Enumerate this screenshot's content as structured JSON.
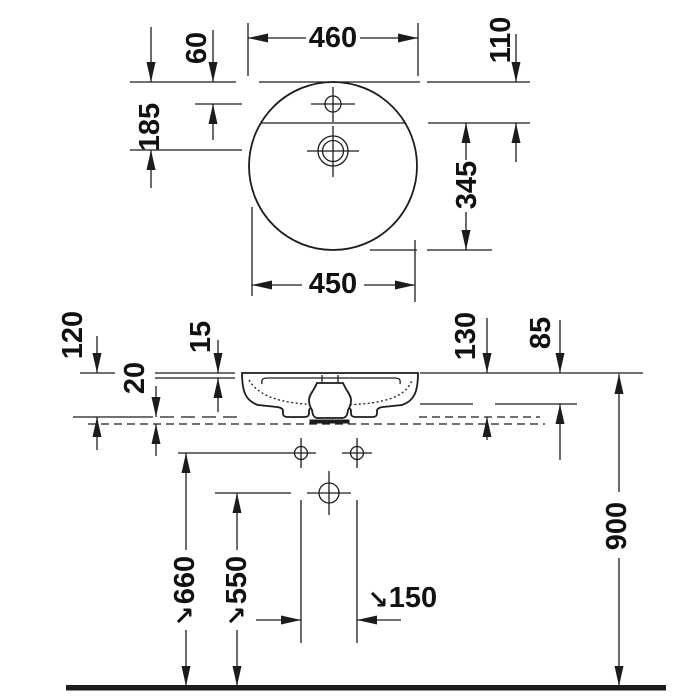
{
  "drawing": {
    "type": "washbasin-technical-dimension-drawing",
    "line_color": "#1c1c1c",
    "background": "#ffffff",
    "top_view": {
      "overall_width": "460",
      "faucet_hole_offset": "60",
      "drain_center_offset": "185",
      "rear_ledge_depth": "110",
      "bowl_front_depth": "345",
      "bowl_width": "450"
    },
    "front_view": {
      "height_above_counter": "120",
      "rim_thickness": "15",
      "counter_thickness": "20",
      "total_height": "130",
      "body_height": "85",
      "rim_height_from_floor": "900",
      "fixing_holes_height": "660",
      "drain_height_from_floor": "550",
      "fixing_holes_spacing": "150",
      "leader_glyph": "↘"
    }
  }
}
